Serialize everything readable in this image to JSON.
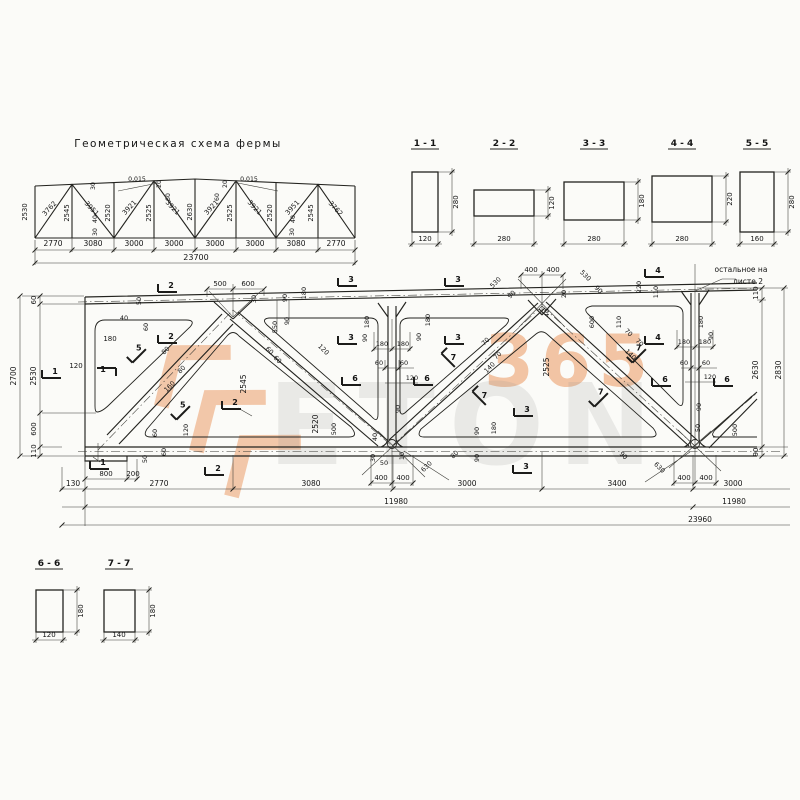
{
  "scheme": {
    "title": "Геометрическая схема фермы",
    "total": "23700",
    "labels": [
      [
        "2530",
        27,
        212,
        -90,
        6.8
      ],
      [
        "3762",
        51,
        210,
        -47,
        6.8
      ],
      [
        "3951",
        90,
        210,
        47,
        6.8
      ],
      [
        "3921",
        131,
        209,
        -47,
        6.8
      ],
      [
        "3921",
        171,
        209,
        47,
        6.8
      ],
      [
        "3921",
        213,
        209,
        -47,
        6.8
      ],
      [
        "3921",
        253,
        209,
        47,
        6.8
      ],
      [
        "3951",
        294,
        209,
        -47,
        6.8
      ],
      [
        "3762",
        334,
        210,
        47,
        6.8
      ],
      [
        "2545",
        69,
        213,
        -90,
        6.8
      ],
      [
        "2520",
        110,
        213,
        -90,
        6.8
      ],
      [
        "2525",
        151,
        213,
        -90,
        6.8
      ],
      [
        "2630",
        192,
        212,
        -90,
        6.8
      ],
      [
        "2525",
        232,
        213,
        -90,
        6.8
      ],
      [
        "2520",
        272,
        213,
        -90,
        6.8
      ],
      [
        "2545",
        313,
        213,
        -90,
        6.8
      ],
      [
        "30",
        95,
        186,
        -90,
        6.2
      ],
      [
        "40",
        97,
        219,
        -90,
        6.2
      ],
      [
        "30",
        97,
        232,
        -90,
        6.2
      ],
      [
        "0,015",
        137,
        181,
        0,
        6.2
      ],
      [
        "0,015",
        249,
        181,
        0,
        6.2
      ],
      [
        "20",
        161,
        184,
        -90,
        6.2
      ],
      [
        "60",
        170,
        197,
        -90,
        6.2
      ],
      [
        "60",
        219,
        197,
        -90,
        6.2
      ],
      [
        "20",
        227,
        184,
        -90,
        6.2
      ],
      [
        "40",
        295,
        219,
        -90,
        6.2
      ],
      [
        "30",
        294,
        232,
        -90,
        6.2
      ],
      [
        "2770",
        53,
        246,
        0,
        7.5
      ],
      [
        "3080",
        93,
        246,
        0,
        7.5
      ],
      [
        "3000",
        134,
        246,
        0,
        7.5
      ],
      [
        "3000",
        174,
        246,
        0,
        7.5
      ],
      [
        "3000",
        215,
        246,
        0,
        7.5
      ],
      [
        "3000",
        255,
        246,
        0,
        7.5
      ],
      [
        "3080",
        296,
        246,
        0,
        7.5
      ],
      [
        "2770",
        336,
        246,
        0,
        7.5
      ],
      [
        "23700",
        196,
        260,
        0,
        8
      ]
    ]
  },
  "sections": {
    "top": [
      {
        "id": "1 - 1",
        "w": "120",
        "h": "280"
      },
      {
        "id": "2 - 2",
        "w": "280",
        "h": "120"
      },
      {
        "id": "3 - 3",
        "w": "280",
        "h": "180"
      },
      {
        "id": "4 - 4",
        "w": "280",
        "h": "220"
      },
      {
        "id": "5 - 5",
        "w": "160",
        "h": "280"
      }
    ],
    "bottom": [
      {
        "id": "6 - 6",
        "w": "120",
        "h": "180"
      },
      {
        "id": "7 - 7",
        "w": "140",
        "h": "180"
      }
    ]
  },
  "note": {
    "line1": "остальное на",
    "line2": "листе 2"
  },
  "main_labels": [
    [
      "60",
      36,
      300,
      -90,
      7
    ],
    [
      "2700",
      16,
      376,
      -90,
      7.5
    ],
    [
      "2530",
      36,
      376,
      -90,
      7.5
    ],
    [
      "600",
      36,
      429,
      -90,
      7
    ],
    [
      "110",
      36,
      451,
      -90,
      7
    ],
    [
      "110",
      758,
      293,
      -90,
      7
    ],
    [
      "2630",
      758,
      370,
      -90,
      7.5
    ],
    [
      "90",
      758,
      452,
      -90,
      7
    ],
    [
      "2830",
      781,
      370,
      -90,
      7.5
    ],
    [
      "130",
      73,
      486,
      0,
      7.5
    ],
    [
      "2770",
      159,
      486,
      0,
      7.5
    ],
    [
      "3080",
      311,
      486,
      0,
      7.5
    ],
    [
      "3000",
      467,
      486,
      0,
      7.5
    ],
    [
      "3400",
      617,
      486,
      0,
      7.5
    ],
    [
      "3000",
      733,
      486,
      0,
      7.5
    ],
    [
      "11980",
      396,
      504,
      0,
      7.5
    ],
    [
      "11980",
      734,
      504,
      0,
      7.5
    ],
    [
      "23960",
      700,
      522,
      0,
      7.5
    ],
    [
      "800",
      106,
      476,
      0,
      7
    ],
    [
      "200",
      133,
      476,
      0,
      7
    ],
    [
      "500",
      220,
      286,
      0,
      7
    ],
    [
      "600",
      248,
      286,
      0,
      7
    ],
    [
      "30",
      256,
      299,
      -90,
      6.5
    ],
    [
      "90",
      287,
      298,
      -90,
      6.5
    ],
    [
      "180",
      306,
      293,
      -90,
      6.5
    ],
    [
      "550",
      277,
      327,
      -90,
      6.5
    ],
    [
      "90",
      289,
      321,
      -90,
      6.5
    ],
    [
      "50",
      141,
      301,
      -90,
      6.5
    ],
    [
      "40",
      124,
      320,
      0,
      6.5
    ],
    [
      "60",
      148,
      327,
      -90,
      6.5
    ],
    [
      "180",
      110,
      341,
      0,
      7
    ],
    [
      "120",
      76,
      368,
      0,
      7
    ],
    [
      "80",
      167,
      352,
      -45,
      6.5
    ],
    [
      "80",
      183,
      371,
      -45,
      6.5
    ],
    [
      "160",
      171,
      388,
      -45,
      6.5
    ],
    [
      "2545",
      246,
      384,
      -90,
      7.5
    ],
    [
      "60",
      268,
      352,
      45,
      6.5
    ],
    [
      "60",
      276,
      361,
      45,
      6.5
    ],
    [
      "120",
      322,
      351,
      45,
      6.5
    ],
    [
      "2520",
      318,
      424,
      -90,
      7.5
    ],
    [
      "500",
      336,
      429,
      -90,
      6.5
    ],
    [
      "60",
      157,
      433,
      -90,
      6.5
    ],
    [
      "120",
      188,
      430,
      -90,
      6.5
    ],
    [
      "50",
      147,
      459,
      -90,
      6.5
    ],
    [
      "60",
      166,
      452,
      -90,
      6.5
    ],
    [
      "40",
      377,
      437,
      -90,
      6.5
    ],
    [
      "30",
      375,
      458,
      -90,
      6.5
    ],
    [
      "50",
      384,
      465,
      0,
      6.5
    ],
    [
      "10",
      404,
      456,
      -90,
      6.5
    ],
    [
      "400",
      381,
      480,
      0,
      7
    ],
    [
      "400",
      403,
      480,
      0,
      7
    ],
    [
      "630",
      428,
      468,
      -45,
      6.5
    ],
    [
      "80",
      456,
      456,
      -45,
      6.5
    ],
    [
      "90",
      479,
      431,
      -90,
      6.5
    ],
    [
      "180",
      496,
      428,
      -90,
      6.5
    ],
    [
      "90",
      479,
      458,
      -90,
      6.5
    ],
    [
      "180",
      382,
      346,
      0,
      6.5
    ],
    [
      "180",
      403,
      346,
      0,
      6.5
    ],
    [
      "60",
      379,
      365,
      0,
      6.5
    ],
    [
      "60",
      404,
      365,
      0,
      6.5
    ],
    [
      "120",
      412,
      380,
      0,
      6.5
    ],
    [
      "90",
      400,
      409,
      -90,
      6.5
    ],
    [
      "180",
      369,
      322,
      -90,
      6.5
    ],
    [
      "90",
      367,
      338,
      -90,
      6.5
    ],
    [
      "180",
      430,
      320,
      -90,
      6.5
    ],
    [
      "90",
      421,
      337,
      -90,
      6.5
    ],
    [
      "70",
      487,
      343,
      -45,
      6.5
    ],
    [
      "70",
      499,
      357,
      -45,
      6.5
    ],
    [
      "140",
      491,
      369,
      -45,
      6.5
    ],
    [
      "2525",
      549,
      367,
      -90,
      7.5
    ],
    [
      "530",
      497,
      284,
      -45,
      6.5
    ],
    [
      "90",
      513,
      296,
      -45,
      6.5
    ],
    [
      "400",
      531,
      272,
      0,
      7
    ],
    [
      "400",
      553,
      272,
      0,
      7
    ],
    [
      "530",
      584,
      277,
      45,
      6.5
    ],
    [
      "90",
      597,
      291,
      45,
      6.5
    ],
    [
      "20",
      566,
      294,
      -90,
      6.5
    ],
    [
      "40",
      549,
      313,
      -90,
      6.5
    ],
    [
      "600",
      594,
      322,
      -90,
      6.5
    ],
    [
      "110",
      621,
      322,
      -90,
      6.5
    ],
    [
      "220",
      641,
      287,
      -90,
      6.5
    ],
    [
      "110",
      658,
      292,
      -90,
      6.5
    ],
    [
      "70",
      627,
      334,
      45,
      6.5
    ],
    [
      "70",
      638,
      344,
      45,
      6.5
    ],
    [
      "140",
      629,
      356,
      45,
      6.5
    ],
    [
      "180",
      703,
      322,
      -90,
      6.5
    ],
    [
      "180",
      684,
      344,
      0,
      6.5
    ],
    [
      "180",
      705,
      344,
      0,
      6.5
    ],
    [
      "90",
      713,
      336,
      -90,
      6.5
    ],
    [
      "60",
      684,
      365,
      0,
      6.5
    ],
    [
      "60",
      706,
      365,
      0,
      6.5
    ],
    [
      "120",
      710,
      379,
      0,
      6.5
    ],
    [
      "90",
      701,
      407,
      -90,
      6.5
    ],
    [
      "50",
      700,
      428,
      -90,
      6.5
    ],
    [
      "500",
      737,
      430,
      -90,
      6.5
    ],
    [
      "630",
      658,
      469,
      45,
      6.5
    ],
    [
      "90",
      622,
      457,
      45,
      6.5
    ],
    [
      "400",
      684,
      480,
      0,
      7
    ],
    [
      "400",
      706,
      480,
      0,
      7
    ]
  ],
  "markers": [
    [
      "1",
      52,
      373,
      0
    ],
    [
      "1",
      106,
      373,
      180
    ],
    [
      "1",
      100,
      464,
      0
    ],
    [
      "2",
      168,
      287,
      0
    ],
    [
      "2",
      168,
      338,
      0
    ],
    [
      "2",
      232,
      404,
      0
    ],
    [
      "2",
      215,
      470,
      0
    ],
    [
      "3",
      348,
      281,
      0
    ],
    [
      "3",
      348,
      339,
      0
    ],
    [
      "3",
      455,
      281,
      0
    ],
    [
      "3",
      455,
      339,
      0
    ],
    [
      "3",
      524,
      411,
      0
    ],
    [
      "3",
      523,
      468,
      0
    ],
    [
      "4",
      655,
      272,
      0
    ],
    [
      "4",
      655,
      339,
      0
    ],
    [
      "5",
      136,
      352,
      -45
    ],
    [
      "5",
      180,
      409,
      -45
    ],
    [
      "6",
      352,
      380,
      0
    ],
    [
      "6",
      424,
      380,
      0
    ],
    [
      "6",
      662,
      381,
      0
    ],
    [
      "6",
      724,
      381,
      0
    ],
    [
      "7",
      452,
      357,
      45
    ],
    [
      "7",
      483,
      395,
      45
    ],
    [
      "7",
      636,
      352,
      -45
    ],
    [
      "7",
      598,
      396,
      -45
    ]
  ],
  "watermark": {
    "digits": "365",
    "word": "ETON",
    "orange": "#e8823f",
    "grey": "#8f8f8f"
  }
}
